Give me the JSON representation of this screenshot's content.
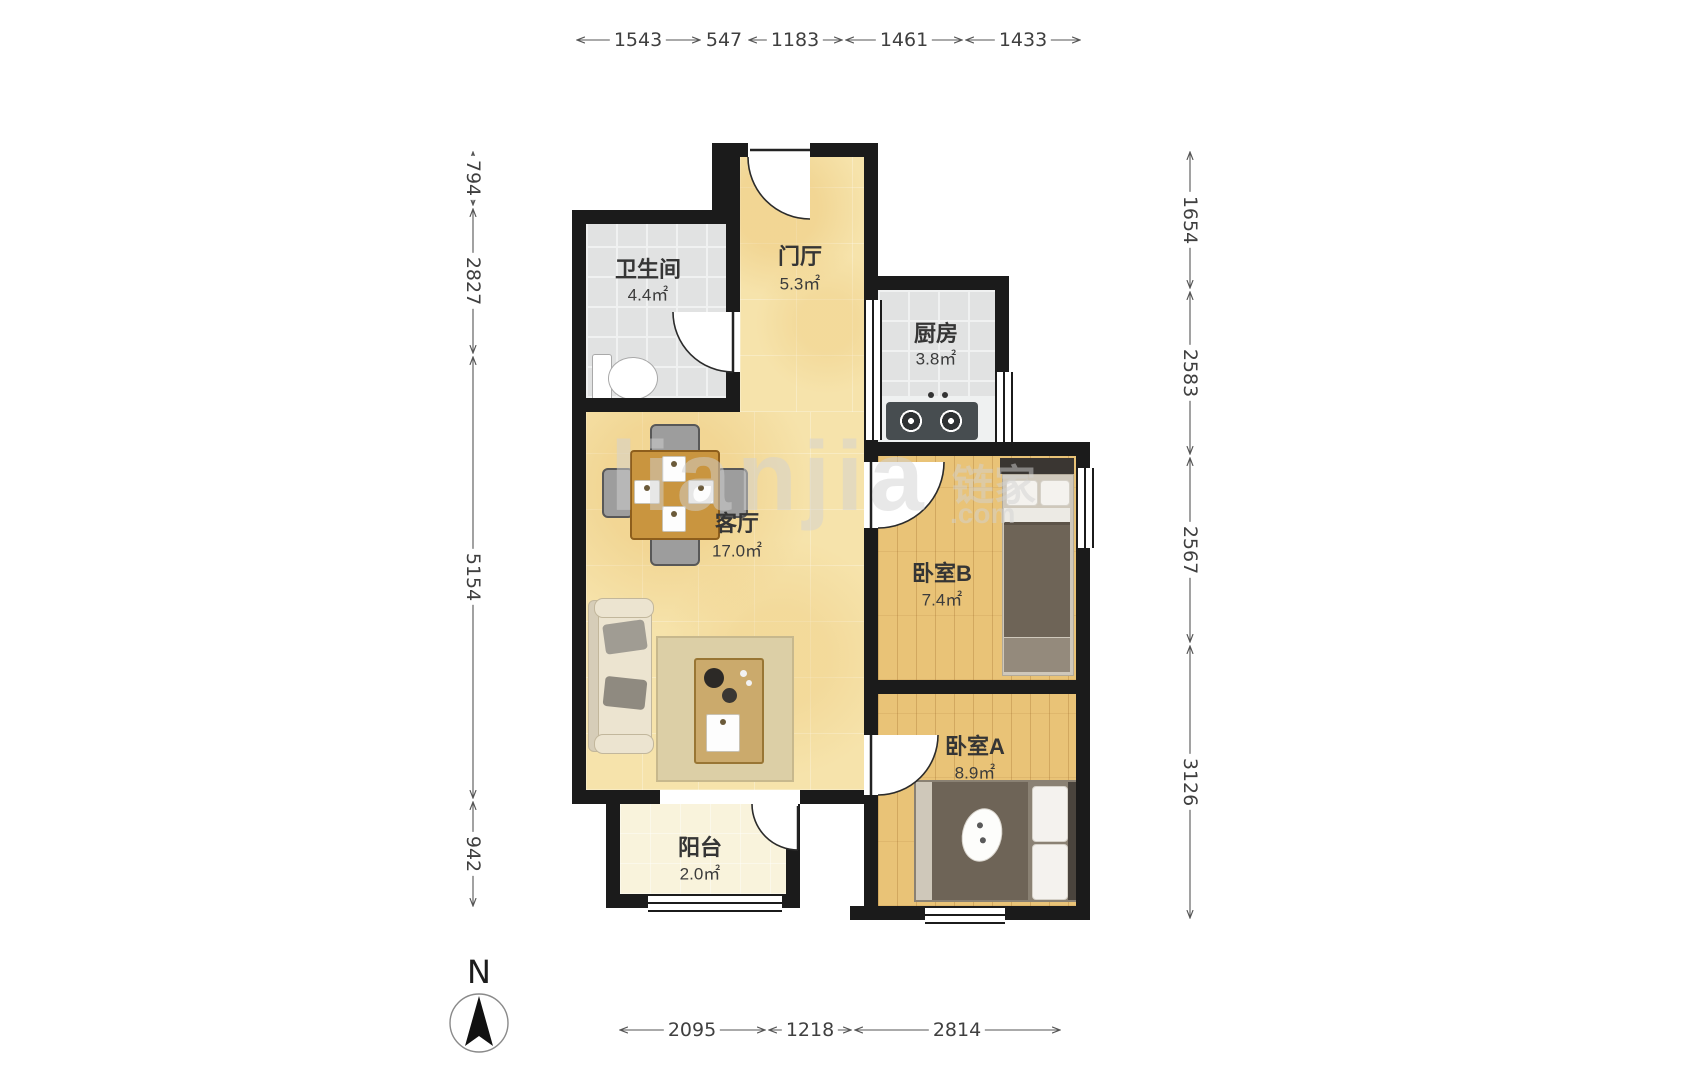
{
  "plan": {
    "rooms": [
      {
        "key": "bathroom",
        "name": "卫生间",
        "area": "4.4㎡"
      },
      {
        "key": "hall",
        "name": "门厅",
        "area": "5.3㎡"
      },
      {
        "key": "kitchen",
        "name": "厨房",
        "area": "3.8㎡"
      },
      {
        "key": "living",
        "name": "客厅",
        "area": "17.0㎡"
      },
      {
        "key": "bedroom_b",
        "name": "卧室B",
        "area": "7.4㎡"
      },
      {
        "key": "bedroom_a",
        "name": "卧室A",
        "area": "8.9㎡"
      },
      {
        "key": "balcony",
        "name": "阳台",
        "area": "2.0㎡"
      }
    ],
    "compass": {
      "label": "N"
    },
    "watermark": {
      "main": "lianjia",
      "cn": "链家",
      "com": ".com"
    }
  },
  "dimensions": {
    "top": [
      "1543",
      "547",
      "1183",
      "1461",
      "1433"
    ],
    "left": [
      "794",
      "2827",
      "5154",
      "942"
    ],
    "right": [
      "1654",
      "2583",
      "2567",
      "3126"
    ],
    "bottom": [
      "2095",
      "1218",
      "2814"
    ]
  },
  "colors": {
    "wall": "#1b1b1b",
    "floor_warm": "#f6e3ab",
    "floor_tile": "#e1e2e2",
    "floor_wood": "#e9c377",
    "floor_balcony": "#f9f3dc",
    "dim_text": "#3f3f3f"
  }
}
